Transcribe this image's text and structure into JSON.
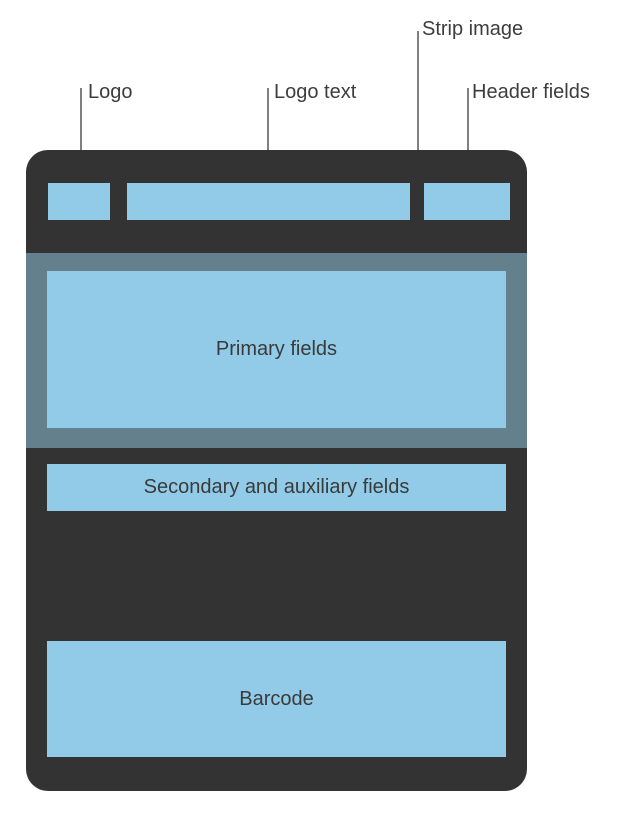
{
  "diagram": {
    "title": "Pass layout diagram",
    "callouts": {
      "strip_image": "Strip image",
      "logo": "Logo",
      "logo_text": "Logo text",
      "header_fields": "Header fields"
    },
    "pass_regions": {
      "primary_fields": "Primary fields",
      "secondary_auxiliary_fields": "Secondary and auxiliary fields",
      "barcode": "Barcode"
    },
    "colors": {
      "pass_body": "#333333",
      "strip": "#65808d",
      "field_region": "#92cbe8",
      "region_text": "#3a3a3a",
      "label_text": "#3d3d3d",
      "leader_line_dark": "#7f7f7f",
      "leader_line_light": "#ffffff"
    }
  }
}
